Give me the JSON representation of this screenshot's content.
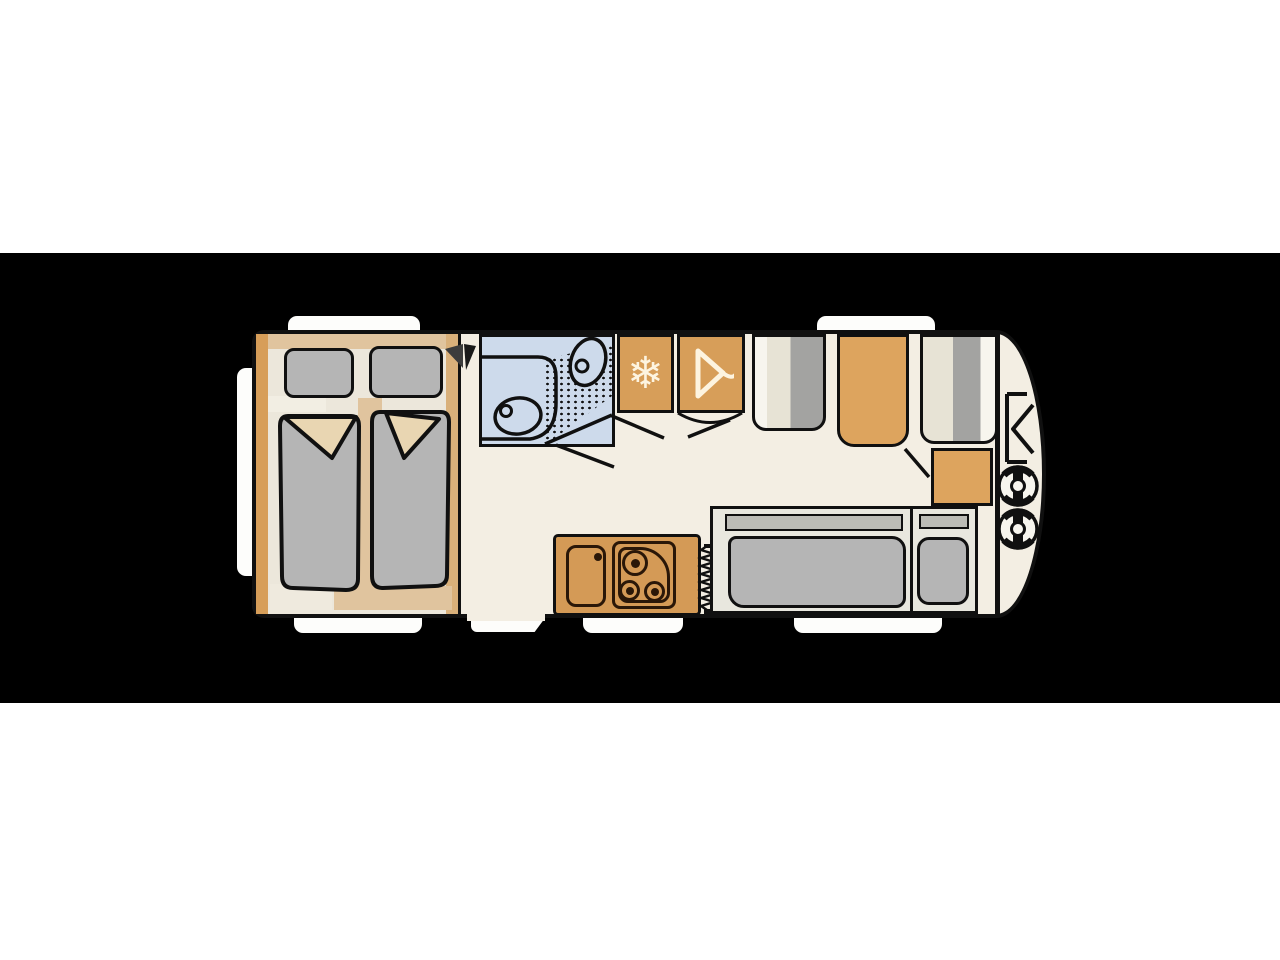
{
  "scene": {
    "description": "Top-view caravan floor plan drawn on a black horizontal band over a white page",
    "page_background": "#ffffff",
    "band_background": "#000000"
  },
  "colors": {
    "page": "#ffffff",
    "band": "#000000",
    "outline": "#101010",
    "floor": "#f3eee3",
    "bedfloor": "#ece7db",
    "wood": "#d79e59",
    "woodlight": "#e0c49e",
    "woodmid": "#d9b07a",
    "table": "#dda45e",
    "kitchen": "#d49a56",
    "cushion": "#b5b5b5",
    "benchgray": "#a3a3a1",
    "benchbeige": "#e7e3d5",
    "benchwhite": "#f7f5ee",
    "bath": "#cddaeb",
    "frame": "#e8e7de",
    "backrest": "#bcbcb6",
    "fold": "#e9d6b2",
    "icon": "#fdf4e0",
    "dark": "#2a1708",
    "white": "#fdfdfb"
  },
  "floorplan": {
    "type": "caravan",
    "orientation": "hitch-at-right",
    "windows": 6,
    "entrance": "door opening with step, bottom wall between bedroom and kitchen",
    "icons": {
      "fridge_glyph": "❄",
      "wardrobe_icon": "clothes-hanger",
      "heater_icon": "zigzag-coil",
      "hitch_icon": "bracket-chevron",
      "gas_bottle_count": 2
    },
    "rooms": [
      {
        "id": "bedroom",
        "label": "twin-bed bedroom",
        "items": [
          "pillow-left",
          "pillow-right",
          "duvet-left",
          "duvet-right",
          "wardrobe-wall"
        ]
      },
      {
        "id": "bathroom",
        "label": "washroom",
        "items": [
          "toilet",
          "washbasin",
          "shower-tray",
          "counter"
        ]
      },
      {
        "id": "storage",
        "label": "tall cabinets",
        "items": [
          "fridge",
          "wardrobe"
        ]
      },
      {
        "id": "dinette",
        "label": "front dinette",
        "items": [
          "bench-left",
          "table",
          "bench-right",
          "low-cabinet"
        ]
      },
      {
        "id": "kitchen",
        "label": "kitchen block",
        "items": [
          "sink",
          "hob-3-burner",
          "heater"
        ]
      },
      {
        "id": "lounge",
        "label": "side sofa bed",
        "items": [
          "backrest",
          "seat-cushion",
          "pillow"
        ]
      },
      {
        "id": "front-locker",
        "label": "gas locker",
        "items": [
          "hitch",
          "gas-bottle-1",
          "gas-bottle-2"
        ]
      }
    ]
  }
}
